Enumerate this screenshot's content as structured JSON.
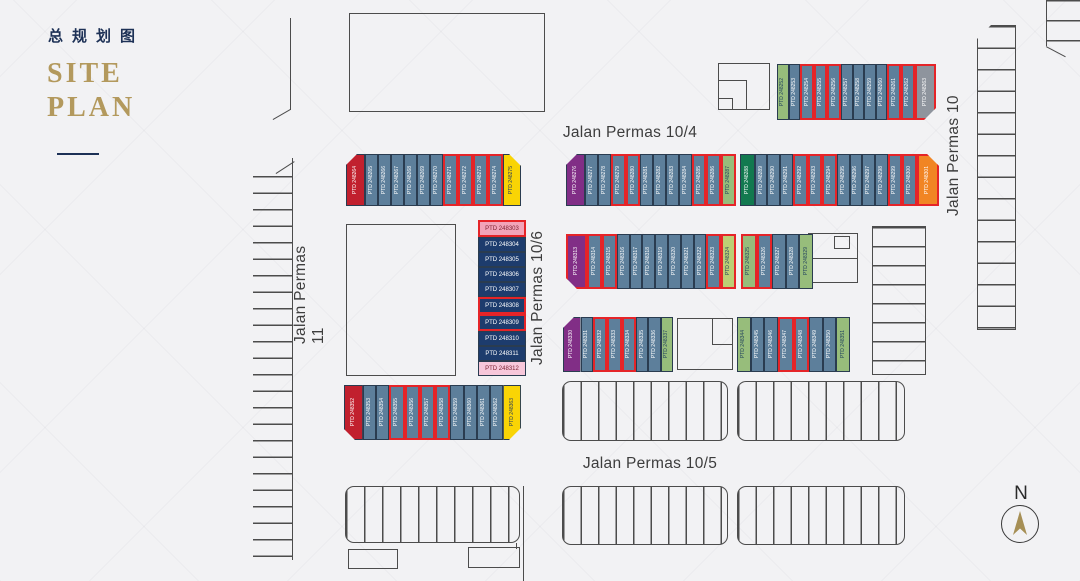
{
  "title": {
    "chinese": "总规划图",
    "english_line1": "SITE",
    "english_line2": "PLAN"
  },
  "streets": {
    "permas_10_4": "Jalan Permas 10/4",
    "permas_10_5": "Jalan Permas 10/5",
    "permas_10_6": "Jalan Permas 10/6",
    "permas_11": "Jalan Permas 11",
    "permas_10": "Jalan Permas 10"
  },
  "compass": {
    "label": "N"
  },
  "highlight_border": "#e52428",
  "palette": {
    "steel": {
      "bg": "#5d7f9b",
      "fg": "#ffffff"
    },
    "navy": {
      "bg": "#1d3c6d",
      "fg": "#ffffff"
    },
    "red": {
      "bg": "#c1202e",
      "fg": "#ffffff"
    },
    "yellow": {
      "bg": "#f9d405",
      "fg": "#23395e"
    },
    "orange": {
      "bg": "#f18524",
      "fg": "#ffffff"
    },
    "purple": {
      "bg": "#812e86",
      "fg": "#ffffff"
    },
    "green_dark": {
      "bg": "#12794f",
      "fg": "#ffffff"
    },
    "green_light": {
      "bg": "#97bd7b",
      "fg": "#23445e"
    },
    "green_yellow": {
      "bg": "#bccf75",
      "fg": "#23445e"
    },
    "pink": {
      "bg": "#f2a4b9",
      "fg": "#7c2231"
    },
    "pink_light": {
      "bg": "#f7c7da",
      "fg": "#7c2231"
    },
    "gray": {
      "bg": "#8e949d",
      "fg": "#ffffff"
    }
  },
  "clusters": [
    {
      "name": "row-north-of-permas-10-4",
      "x": 777,
      "y": 64,
      "w": 159,
      "h": 56,
      "dir": "h",
      "lots": [
        {
          "n": "PTD 248252",
          "c": "green_light"
        },
        {
          "n": "PTD 248253",
          "c": "steel"
        },
        {
          "n": "PTD 248254",
          "c": "steel",
          "sel": true
        },
        {
          "n": "PTD 248255",
          "c": "steel",
          "sel": true
        },
        {
          "n": "PTD 248256",
          "c": "steel",
          "sel": true
        },
        {
          "n": "PTD 248257",
          "c": "steel"
        },
        {
          "n": "PTD 248258",
          "c": "steel"
        },
        {
          "n": "PTD 248259",
          "c": "steel"
        },
        {
          "n": "PTD 248260",
          "c": "steel"
        },
        {
          "n": "PTD 248261",
          "c": "steel",
          "sel": true
        },
        {
          "n": "PTD 248262",
          "c": "steel",
          "sel": true
        },
        {
          "n": "PTD 248263",
          "c": "gray",
          "sel": true,
          "wf": 1.8,
          "clip": "br"
        }
      ]
    },
    {
      "name": "row2-west",
      "x": 346,
      "y": 154,
      "w": 175,
      "h": 52,
      "dir": "h",
      "lots": [
        {
          "n": "PTD 248264",
          "c": "red",
          "wf": 1.6,
          "clip": "tl"
        },
        {
          "n": "PTD 248265",
          "c": "steel"
        },
        {
          "n": "PTD 248266",
          "c": "steel"
        },
        {
          "n": "PTD 248267",
          "c": "steel"
        },
        {
          "n": "PTD 248268",
          "c": "steel"
        },
        {
          "n": "PTD 248269",
          "c": "steel"
        },
        {
          "n": "PTD 248270",
          "c": "steel"
        },
        {
          "n": "PTD 248271",
          "c": "steel",
          "sel": true
        },
        {
          "n": "PTD 248272",
          "c": "steel",
          "sel": true
        },
        {
          "n": "PTD 248273",
          "c": "steel",
          "sel": true
        },
        {
          "n": "PTD 248274",
          "c": "steel",
          "sel": true
        },
        {
          "n": "PTD 248275",
          "c": "yellow",
          "wf": 1.5,
          "clip": "tr"
        }
      ]
    },
    {
      "name": "row2-mid",
      "x": 566,
      "y": 154,
      "w": 170,
      "h": 52,
      "dir": "h",
      "lots": [
        {
          "n": "PTD 248276",
          "c": "purple",
          "wf": 1.6,
          "clip": "tl"
        },
        {
          "n": "PTD 248277",
          "c": "steel"
        },
        {
          "n": "PTD 248278",
          "c": "steel"
        },
        {
          "n": "PTD 248279",
          "c": "steel",
          "sel": true
        },
        {
          "n": "PTD 248280",
          "c": "steel",
          "sel": true
        },
        {
          "n": "PTD 248281",
          "c": "steel"
        },
        {
          "n": "PTD 248282",
          "c": "steel"
        },
        {
          "n": "PTD 248283",
          "c": "steel"
        },
        {
          "n": "PTD 248284",
          "c": "steel"
        },
        {
          "n": "PTD 248285",
          "c": "steel",
          "sel": true
        },
        {
          "n": "PTD 248286",
          "c": "steel",
          "sel": true
        },
        {
          "n": "PTD 248287",
          "c": "green_light",
          "sel": true
        }
      ]
    },
    {
      "name": "row2-east",
      "x": 740,
      "y": 154,
      "w": 199,
      "h": 52,
      "dir": "h",
      "lots": [
        {
          "n": "PTD 248288",
          "c": "green_dark",
          "wf": 1.2
        },
        {
          "n": "PTD 248289",
          "c": "steel"
        },
        {
          "n": "PTD 248290",
          "c": "steel"
        },
        {
          "n": "PTD 248291",
          "c": "steel"
        },
        {
          "n": "PTD 248292",
          "c": "steel",
          "sel": true
        },
        {
          "n": "PTD 248293",
          "c": "steel",
          "sel": true
        },
        {
          "n": "PTD 248294",
          "c": "steel",
          "sel": true
        },
        {
          "n": "PTD 248295",
          "c": "steel"
        },
        {
          "n": "PTD 248296",
          "c": "steel"
        },
        {
          "n": "PTD 248297",
          "c": "steel"
        },
        {
          "n": "PTD 248298",
          "c": "steel"
        },
        {
          "n": "PTD 248299",
          "c": "steel",
          "sel": true
        },
        {
          "n": "PTD 248300",
          "c": "steel",
          "sel": true
        },
        {
          "n": "PTD 248301",
          "c": "orange",
          "sel": true,
          "wf": 1.7,
          "clip": "tr"
        }
      ]
    },
    {
      "name": "stack-permas-10-6",
      "x": 478,
      "y": 220,
      "w": 48,
      "h": 156,
      "dir": "v",
      "lots": [
        {
          "n": "PTD 248303",
          "c": "pink",
          "sel": true
        },
        {
          "n": "PTD 248304",
          "c": "navy"
        },
        {
          "n": "PTD 248305",
          "c": "navy"
        },
        {
          "n": "PTD 248306",
          "c": "navy"
        },
        {
          "n": "PTD 248307",
          "c": "navy"
        },
        {
          "n": "PTD 248308",
          "c": "navy",
          "sel": true
        },
        {
          "n": "PTD 248309",
          "c": "navy",
          "sel": true
        },
        {
          "n": "PTD 248310",
          "c": "navy"
        },
        {
          "n": "PTD 248311",
          "c": "navy"
        },
        {
          "n": "PTD 248312",
          "c": "pink_light"
        }
      ]
    },
    {
      "name": "row3-west",
      "x": 566,
      "y": 234,
      "w": 170,
      "h": 55,
      "dir": "h",
      "lots": [
        {
          "n": "PTD 248313",
          "c": "purple",
          "sel": true,
          "wf": 1.6,
          "clip": "bl"
        },
        {
          "n": "PTD 248314",
          "c": "steel",
          "sel": true
        },
        {
          "n": "PTD 248315",
          "c": "steel",
          "sel": true
        },
        {
          "n": "PTD 248316",
          "c": "steel"
        },
        {
          "n": "PTD 248317",
          "c": "steel"
        },
        {
          "n": "PTD 248318",
          "c": "steel"
        },
        {
          "n": "PTD 248319",
          "c": "steel"
        },
        {
          "n": "PTD 248320",
          "c": "steel"
        },
        {
          "n": "PTD 248321",
          "c": "steel"
        },
        {
          "n": "PTD 248322",
          "c": "steel"
        },
        {
          "n": "PTD 248323",
          "c": "steel",
          "sel": true
        },
        {
          "n": "PTD 248324",
          "c": "green_yellow",
          "sel": true
        }
      ]
    },
    {
      "name": "row3-east",
      "x": 741,
      "y": 234,
      "w": 72,
      "h": 55,
      "dir": "h",
      "lots": [
        {
          "n": "PTD 248325",
          "c": "green_light",
          "sel": true
        },
        {
          "n": "PTD 248326",
          "c": "steel",
          "sel": true
        },
        {
          "n": "PTD 248327",
          "c": "steel"
        },
        {
          "n": "PTD 248328",
          "c": "steel"
        },
        {
          "n": "PTD 248329",
          "c": "green_light"
        }
      ]
    },
    {
      "name": "row4-west",
      "x": 563,
      "y": 317,
      "w": 110,
      "h": 55,
      "dir": "h",
      "lots": [
        {
          "n": "PTD 248330",
          "c": "purple",
          "wf": 1.5,
          "clip": "tl"
        },
        {
          "n": "PTD 248331",
          "c": "steel"
        },
        {
          "n": "PTD 248332",
          "c": "steel",
          "sel": true
        },
        {
          "n": "PTD 248333",
          "c": "steel",
          "sel": true
        },
        {
          "n": "PTD 248334",
          "c": "steel",
          "sel": true
        },
        {
          "n": "PTD 248335",
          "c": "steel"
        },
        {
          "n": "PTD 248336",
          "c": "steel"
        },
        {
          "n": "PTD 248337",
          "c": "green_light"
        }
      ]
    },
    {
      "name": "row4-east",
      "x": 737,
      "y": 317,
      "w": 113,
      "h": 55,
      "dir": "h",
      "lots": [
        {
          "n": "PTD 248344",
          "c": "green_light"
        },
        {
          "n": "PTD 248345",
          "c": "steel"
        },
        {
          "n": "PTD 248346",
          "c": "steel"
        },
        {
          "n": "PTD 248347",
          "c": "steel",
          "sel": true
        },
        {
          "n": "PTD 248348",
          "c": "steel",
          "sel": true
        },
        {
          "n": "PTD 248349",
          "c": "steel"
        },
        {
          "n": "PTD 248350",
          "c": "steel"
        },
        {
          "n": "PTD 248351",
          "c": "green_light"
        }
      ]
    },
    {
      "name": "row5-west",
      "x": 344,
      "y": 385,
      "w": 177,
      "h": 55,
      "dir": "h",
      "lots": [
        {
          "n": "PTD 248352",
          "c": "red",
          "wf": 1.5,
          "clip": "bl"
        },
        {
          "n": "PTD 248353",
          "c": "steel"
        },
        {
          "n": "PTD 248354",
          "c": "steel"
        },
        {
          "n": "PTD 248355",
          "c": "steel",
          "sel": true
        },
        {
          "n": "PTD 248356",
          "c": "steel",
          "sel": true
        },
        {
          "n": "PTD 248357",
          "c": "steel",
          "sel": true
        },
        {
          "n": "PTD 248358",
          "c": "steel",
          "sel": true
        },
        {
          "n": "PTD 248359",
          "c": "steel"
        },
        {
          "n": "PTD 248360",
          "c": "steel"
        },
        {
          "n": "PTD 248361",
          "c": "steel"
        },
        {
          "n": "PTD 248362",
          "c": "steel"
        },
        {
          "n": "PTD 248363",
          "c": "yellow",
          "wf": 1.4,
          "clip": "br"
        }
      ]
    }
  ]
}
